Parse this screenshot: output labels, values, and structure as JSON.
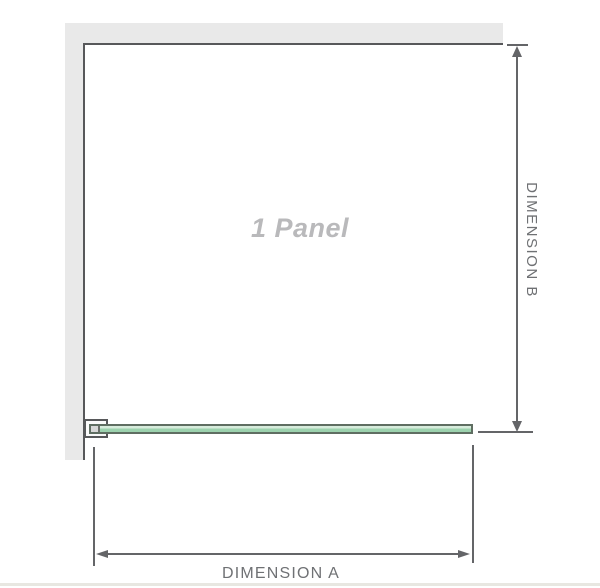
{
  "diagram": {
    "panel_label": "1 Panel",
    "dimension_a_label": "DIMENSION A",
    "dimension_b_label": "DIMENSION B",
    "colors": {
      "page_bg": "#ffffff",
      "wall_fill": "#e9e9e9",
      "wall_edge": "#57585a",
      "glass_fill": "#9cd2ae",
      "glass_highlight": "#d7ecdc",
      "glass_border": "#5f6e62",
      "dimension_line": "#646568",
      "dimension_text": "#6f7174",
      "panel_label_text": "#b9b9bb",
      "footer_rule": "#e8e7e1"
    }
  }
}
